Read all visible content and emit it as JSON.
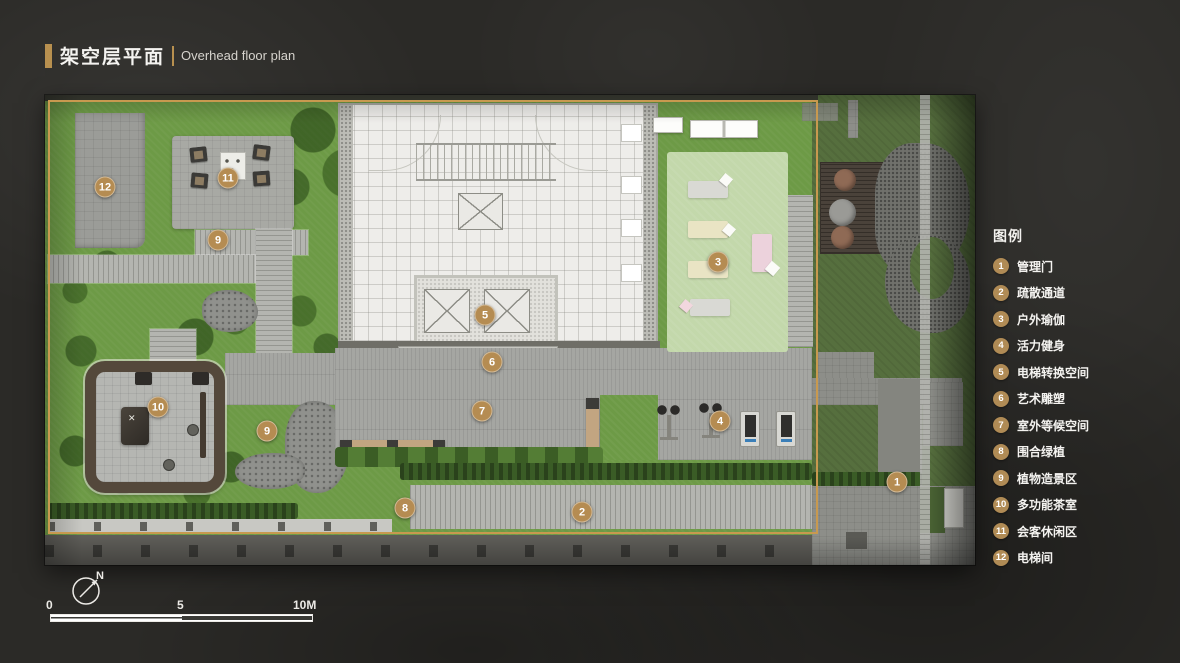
{
  "title": {
    "zh": "架空层平面",
    "en": "Overhead floor plan"
  },
  "legend": {
    "heading": "图例",
    "items": [
      {
        "num": "1",
        "label": "管理门"
      },
      {
        "num": "2",
        "label": "疏散通道"
      },
      {
        "num": "3",
        "label": "户外瑜伽"
      },
      {
        "num": "4",
        "label": "活力健身"
      },
      {
        "num": "5",
        "label": "电梯转换空间"
      },
      {
        "num": "6",
        "label": "艺术雕塑"
      },
      {
        "num": "7",
        "label": "室外等候空间"
      },
      {
        "num": "8",
        "label": "围合绿植"
      },
      {
        "num": "9",
        "label": "植物造景区"
      },
      {
        "num": "10",
        "label": "多功能茶室"
      },
      {
        "num": "11",
        "label": "会客休闲区"
      },
      {
        "num": "12",
        "label": "电梯间"
      }
    ]
  },
  "plan": {
    "badges": [
      {
        "num": "12",
        "label": "电梯间"
      },
      {
        "num": "11",
        "label": "会客休闲区"
      },
      {
        "num": "9",
        "label": "植物造景区"
      },
      {
        "num": "9",
        "label": "植物造景区"
      },
      {
        "num": "10",
        "label": "多功能茶室"
      },
      {
        "num": "5",
        "label": "电梯转换空间"
      },
      {
        "num": "6",
        "label": "艺术雕塑"
      },
      {
        "num": "7",
        "label": "室外等候空间"
      },
      {
        "num": "8",
        "label": "围合绿植"
      },
      {
        "num": "2",
        "label": "疏散通道"
      },
      {
        "num": "3",
        "label": "户外瑜伽"
      },
      {
        "num": "4",
        "label": "活力健身"
      },
      {
        "num": "1",
        "label": "管理门"
      }
    ]
  },
  "scalebar": {
    "tick0": "0",
    "tick5": "5",
    "tick10": "10M"
  },
  "north": {
    "label": "N"
  },
  "colors": {
    "accent_gold": "#b58c52",
    "boundary": "#c8994f",
    "lawn_green": "#6d9a46",
    "title_bar_gold": "#b8904f"
  }
}
